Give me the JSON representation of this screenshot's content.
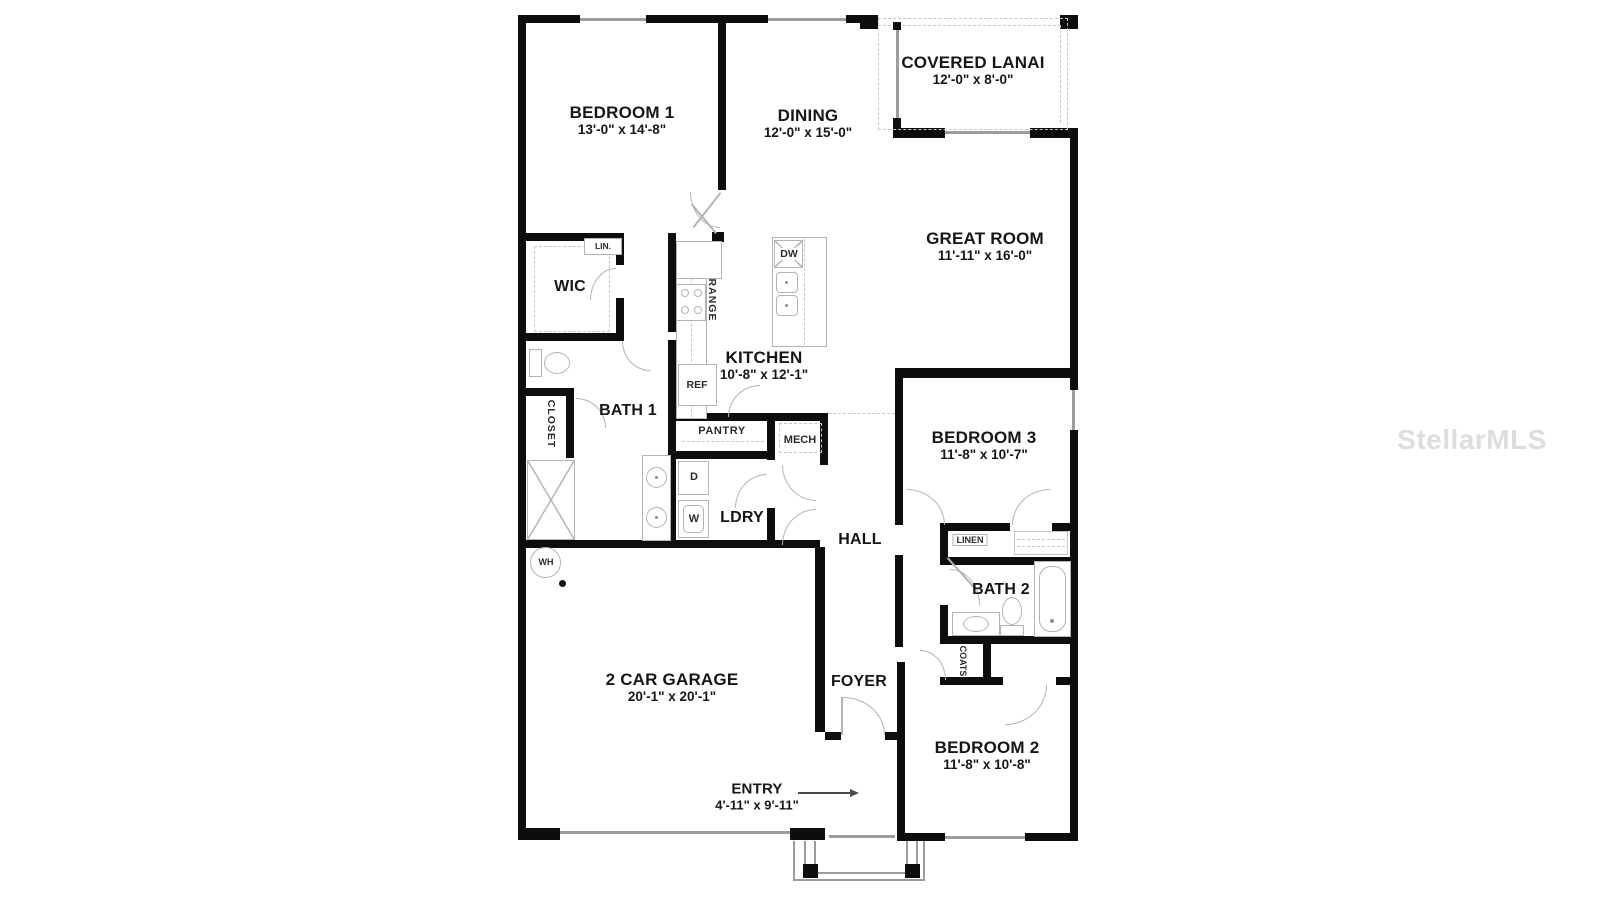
{
  "watermark": "StellarMLS",
  "rooms": {
    "bedroom1": {
      "label": "BEDROOM 1",
      "dims": "13'-0\" x 14'-8\""
    },
    "dining": {
      "label": "DINING",
      "dims": "12'-0\" x 15'-0\""
    },
    "lanai": {
      "label": "COVERED LANAI",
      "dims": "12'-0\" x 8'-0\""
    },
    "great_room": {
      "label": "GREAT ROOM",
      "dims": "11'-11\" x 16'-0\""
    },
    "kitchen": {
      "label": "KITCHEN",
      "dims": "10'-8\" x 12'-1\""
    },
    "bedroom3": {
      "label": "BEDROOM 3",
      "dims": "11'-8\" x 10'-7\""
    },
    "bedroom2": {
      "label": "BEDROOM 2",
      "dims": "11'-8\" x 10'-8\""
    },
    "garage": {
      "label": "2 CAR GARAGE",
      "dims": "20'-1\" x 20'-1\""
    },
    "entry": {
      "label": "ENTRY",
      "dims": "4'-11\" x 9'-11\""
    },
    "wic": {
      "label": "WIC"
    },
    "bath1": {
      "label": "BATH 1"
    },
    "bath2": {
      "label": "BATH 2"
    },
    "hall": {
      "label": "HALL"
    },
    "foyer": {
      "label": "FOYER"
    },
    "ldry": {
      "label": "LDRY"
    }
  },
  "fixtures": {
    "lin": "LIN.",
    "range": "RANGE",
    "ref": "REF",
    "dw": "DW",
    "pantry": "PANTRY",
    "mech": "MECH",
    "closet": "CLOSET",
    "dryer": "D",
    "washer": "W",
    "water_heater": "WH",
    "linen": "LINEN",
    "coats": "COATS"
  }
}
